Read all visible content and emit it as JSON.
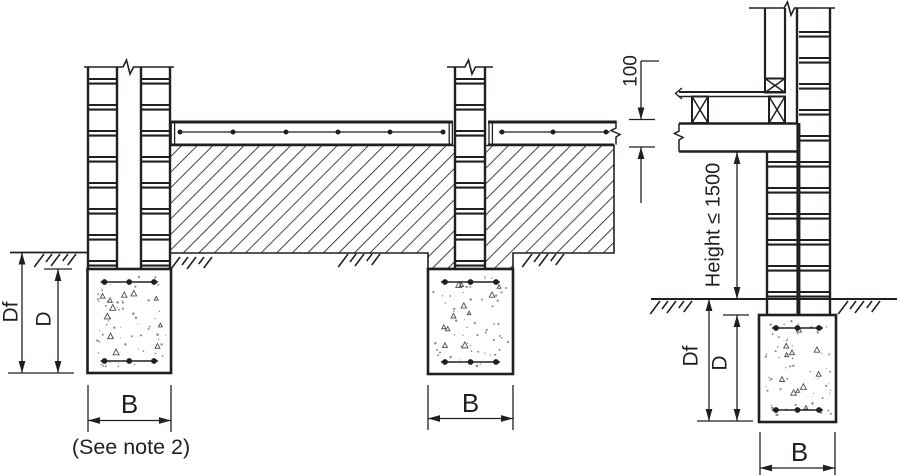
{
  "diagram": {
    "labels": {
      "depth_to_founding": "Df",
      "footing_depth": "D",
      "footing_width": "B",
      "note_reference": "(See note 2)",
      "slab_thickness": "100",
      "wall_height_limit": "Height ≤ 1500"
    },
    "colors": {
      "line": "#231f20",
      "background": "#ffffff",
      "stipple": "#8d8d8d"
    }
  }
}
